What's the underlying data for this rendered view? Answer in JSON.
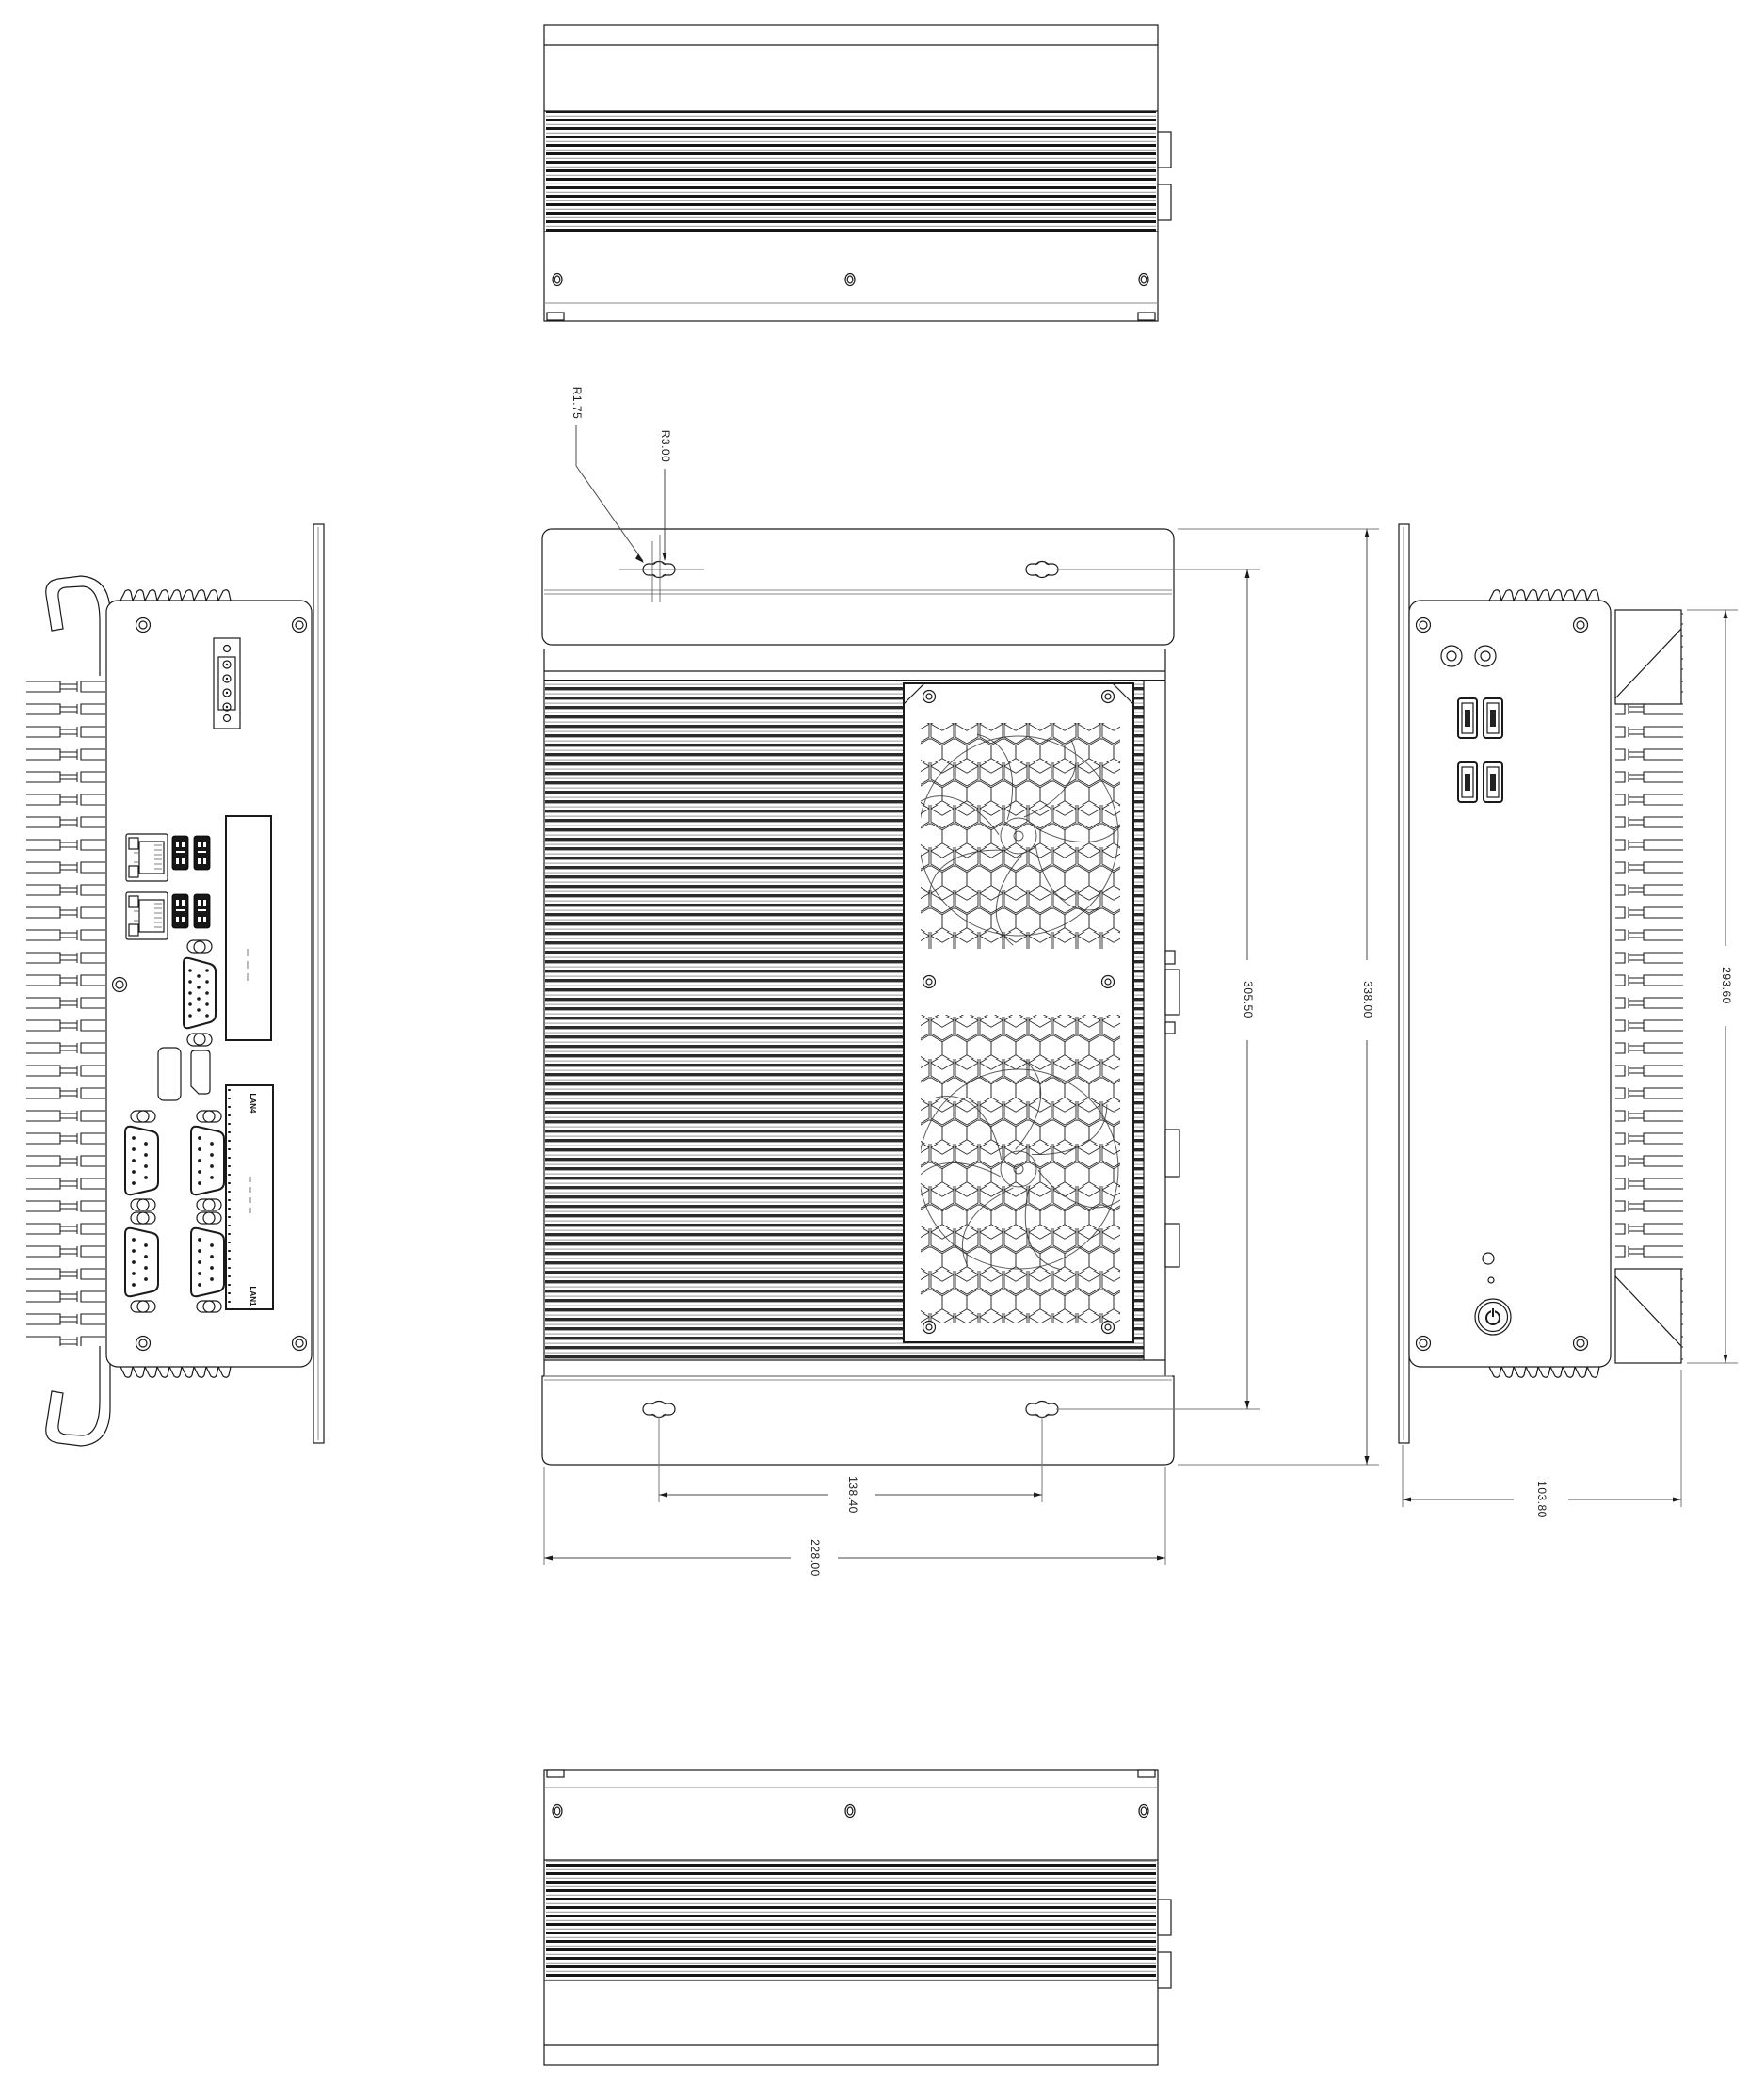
{
  "dimensions": {
    "radius_small": "R1.75",
    "radius_large": "R3.00",
    "slot_spacing_vertical": "305.50",
    "overall_height": "338.00",
    "chassis_height": "293.60",
    "slot_spacing_horizontal": "138.40",
    "overall_width": "228.00",
    "chassis_depth": "103.80"
  },
  "labels": {
    "expansion_slot_top": "LAN4",
    "expansion_slot_bottom": "LAN1"
  },
  "colors": {
    "background": "#ffffff",
    "outline": "#1a1a1a",
    "dimension": "#4a4a4a"
  }
}
